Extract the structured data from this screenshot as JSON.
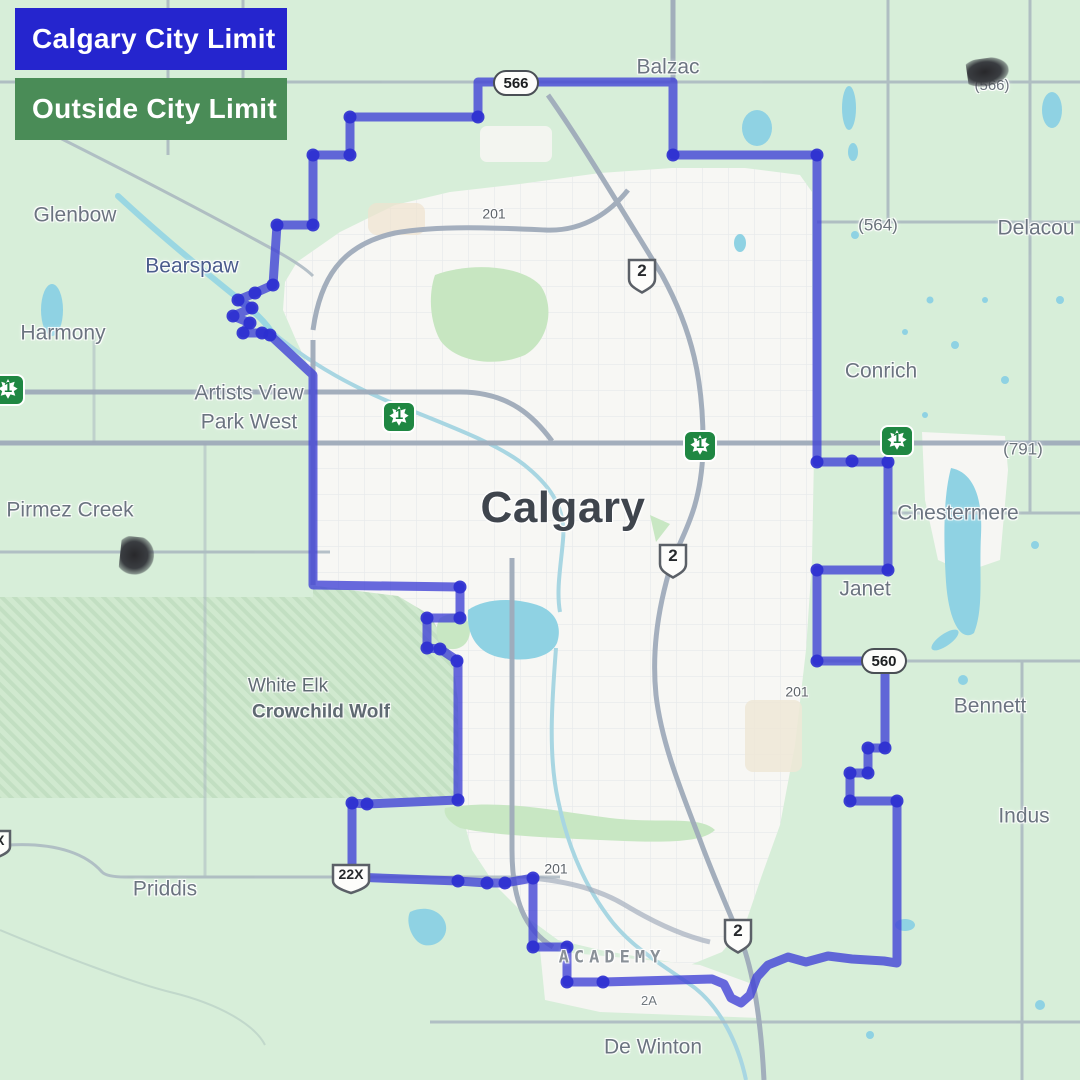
{
  "legend": {
    "calgary_city_limit": "Calgary City Limit",
    "outside_city_limit": "Outside City Limit"
  },
  "colors": {
    "city_limit_blue": "#2525ce",
    "outside_green": "#4a8c57",
    "boundary_line": "#4244d6",
    "boundary_dot": "#2c2fd0",
    "water": "#8fd2e3",
    "land": "#d7eed9",
    "urban": "#f7f7f4"
  },
  "map": {
    "city": "Calgary",
    "places": {
      "balzac": "Balzac",
      "glenbow": "Glenbow",
      "bearspaw": "Bearspaw",
      "harmony": "Harmony",
      "artists_view_line1": "Artists View",
      "artists_view_line2": "Park West",
      "pirmez_creek": "Pirmez Creek",
      "conrich": "Conrich",
      "chestermere": "Chestermere",
      "janet": "Janet",
      "bennett": "Bennett",
      "indus": "Indus",
      "priddis": "Priddis",
      "de_winton": "De Winton",
      "delacour": "Delacou",
      "white_elk": "White Elk",
      "crowchild_wolf": "Crowchild Wolf",
      "academy": "ACADEMY"
    },
    "routes": {
      "hwy_566": "566",
      "hwy_560": "560",
      "hwy_2": "2",
      "hwy_1": "1",
      "hwy_22x": "22X",
      "ring_201": "201",
      "route_564_paren": "(564)",
      "route_791_paren": "(791)",
      "route_566_paren": "(566)",
      "hwy_2a": "2A"
    }
  }
}
